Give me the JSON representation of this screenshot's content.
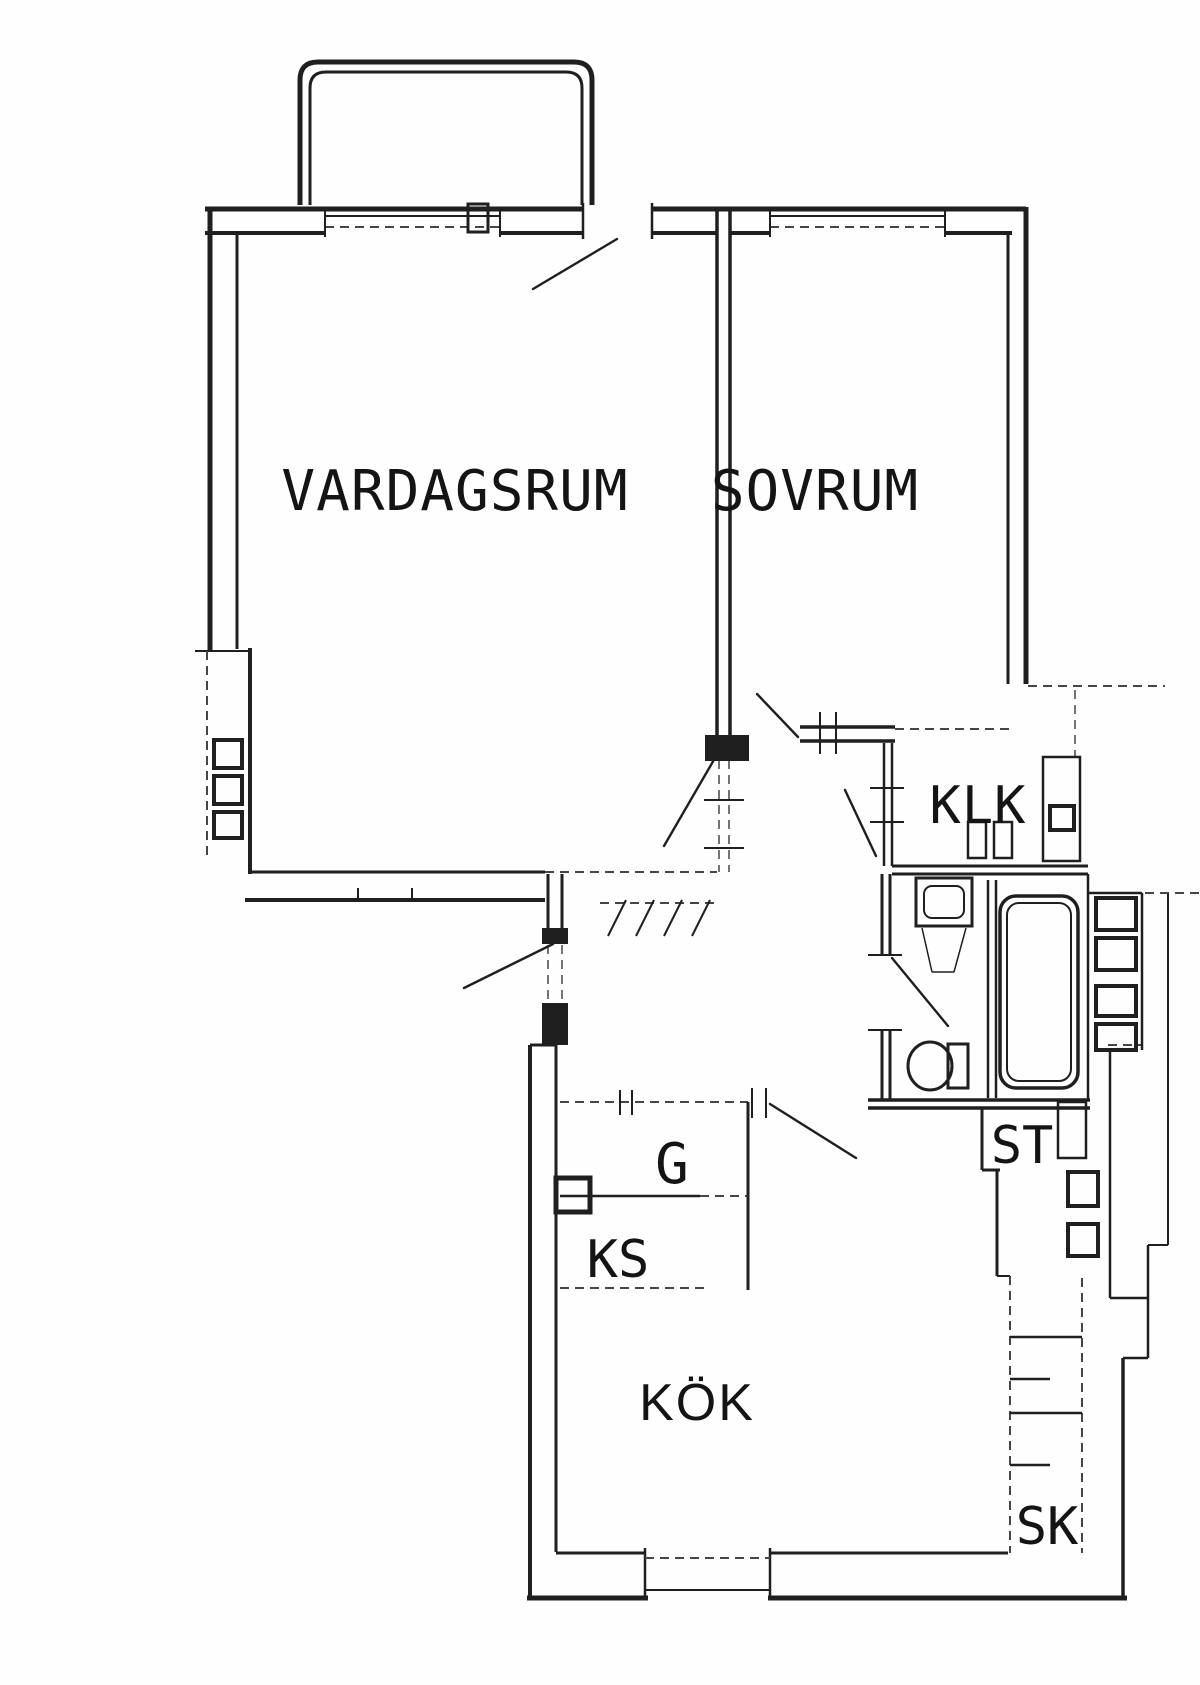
{
  "plan": {
    "background": "#fefefe",
    "ink": "#1f1f1f",
    "ink_soft": "#454545",
    "text_color": "#141414",
    "width": 1200,
    "height": 1685,
    "labels": [
      {
        "n": "room-label-vardagsrum",
        "t": "VARDAGSRUM",
        "x": 455,
        "y": 510,
        "s": 56,
        "f": "mono",
        "ls": 1
      },
      {
        "n": "room-label-sovrum",
        "t": "SOVRUM",
        "x": 815,
        "y": 510,
        "s": 56,
        "f": "mono",
        "ls": 1
      },
      {
        "n": "room-label-klk",
        "t": "KLK",
        "x": 978,
        "y": 823,
        "s": 52,
        "f": "mono",
        "ls": 1
      },
      {
        "n": "closet-label-g",
        "t": "G",
        "x": 672,
        "y": 1183,
        "s": 56,
        "f": "mono",
        "ls": 0
      },
      {
        "n": "appliance-label-ks",
        "t": "KS",
        "x": 618,
        "y": 1277,
        "s": 52,
        "f": "mono",
        "ls": 0
      },
      {
        "n": "closet-label-st",
        "t": "ST",
        "x": 1022,
        "y": 1163,
        "s": 52,
        "f": "mono",
        "ls": 0
      },
      {
        "n": "room-label-kok",
        "t": "KÖK",
        "x": 697,
        "y": 1420,
        "s": 52,
        "f": "sans",
        "ls": 2
      },
      {
        "n": "closet-label-sk",
        "t": "SK",
        "x": 1047,
        "y": 1544,
        "s": 52,
        "f": "mono",
        "ls": 0
      }
    ],
    "walls": [
      [
        205,
        209,
        583,
        209,
        5,
        0
      ],
      [
        652,
        209,
        1026,
        209,
        5,
        0
      ],
      [
        205,
        233,
        325,
        233,
        4,
        0
      ],
      [
        500,
        233,
        583,
        233,
        4,
        0
      ],
      [
        652,
        233,
        717,
        233,
        4,
        0
      ],
      [
        730,
        233,
        770,
        233,
        4,
        0
      ],
      [
        945,
        233,
        1012,
        233,
        4,
        0
      ],
      [
        325,
        216,
        500,
        216,
        2,
        0
      ],
      [
        325,
        227,
        500,
        227,
        2,
        1
      ],
      [
        325,
        207,
        325,
        237,
        2,
        0
      ],
      [
        500,
        207,
        500,
        237,
        2,
        0
      ],
      [
        770,
        216,
        945,
        216,
        2,
        0
      ],
      [
        770,
        227,
        945,
        227,
        2,
        1
      ],
      [
        770,
        207,
        770,
        237,
        2,
        0
      ],
      [
        945,
        207,
        945,
        237,
        2,
        0
      ],
      [
        583,
        203,
        583,
        239,
        2.5,
        0
      ],
      [
        652,
        203,
        652,
        239,
        2.5,
        0
      ],
      [
        210,
        207,
        210,
        651,
        5,
        0
      ],
      [
        237,
        233,
        237,
        649,
        3,
        0
      ],
      [
        195,
        651,
        250,
        651,
        2,
        0
      ],
      [
        207,
        651,
        207,
        858,
        2,
        1
      ],
      [
        250,
        648,
        250,
        874,
        4,
        0
      ],
      [
        1026,
        207,
        1026,
        684,
        5,
        0
      ],
      [
        1008,
        233,
        1008,
        684,
        3,
        0
      ],
      [
        1028,
        686,
        1165,
        686,
        2,
        1
      ],
      [
        1075,
        690,
        1075,
        757,
        1.5,
        1
      ],
      [
        717,
        209,
        717,
        741,
        3.5,
        0
      ],
      [
        730,
        209,
        730,
        741,
        3.5,
        0
      ],
      [
        719,
        760,
        719,
        872,
        1.5,
        1
      ],
      [
        729,
        760,
        729,
        872,
        1.5,
        1
      ],
      [
        704,
        800,
        744,
        800,
        2,
        0
      ],
      [
        704,
        848,
        744,
        848,
        2,
        0
      ],
      [
        800,
        727,
        895,
        727,
        3.5,
        0
      ],
      [
        800,
        741,
        895,
        741,
        3.5,
        0
      ],
      [
        895,
        729,
        1012,
        729,
        2,
        1
      ],
      [
        820,
        712,
        820,
        754,
        2,
        0
      ],
      [
        836,
        712,
        836,
        754,
        2,
        0
      ],
      [
        884,
        743,
        884,
        866,
        2.5,
        0
      ],
      [
        892,
        743,
        892,
        866,
        2.5,
        0
      ],
      [
        870,
        788,
        904,
        788,
        2,
        0
      ],
      [
        870,
        822,
        904,
        822,
        2,
        0
      ],
      [
        892,
        866,
        1088,
        866,
        3,
        0
      ],
      [
        892,
        874,
        1088,
        874,
        3,
        0
      ],
      [
        882,
        874,
        882,
        955,
        3,
        0
      ],
      [
        890,
        874,
        890,
        955,
        3,
        0
      ],
      [
        882,
        1030,
        882,
        1100,
        3,
        0
      ],
      [
        890,
        1030,
        890,
        1100,
        3,
        0
      ],
      [
        868,
        955,
        902,
        955,
        2,
        0
      ],
      [
        868,
        1030,
        902,
        1030,
        2,
        0
      ],
      [
        988,
        880,
        988,
        1098,
        2.5,
        0
      ],
      [
        996,
        880,
        996,
        1098,
        2.5,
        0
      ],
      [
        1088,
        874,
        1088,
        1100,
        2.5,
        0
      ],
      [
        868,
        1100,
        1090,
        1100,
        3.5,
        0
      ],
      [
        868,
        1108,
        1090,
        1108,
        3.5,
        0
      ],
      [
        250,
        872,
        545,
        872,
        3,
        0
      ],
      [
        545,
        872,
        717,
        872,
        2,
        1
      ],
      [
        245,
        900,
        545,
        900,
        4,
        0
      ],
      [
        358,
        888,
        358,
        902,
        2,
        0
      ],
      [
        412,
        888,
        412,
        902,
        2,
        0
      ],
      [
        548,
        874,
        548,
        940,
        3,
        0
      ],
      [
        562,
        874,
        562,
        940,
        3,
        0
      ],
      [
        548,
        945,
        548,
        1005,
        1.5,
        1
      ],
      [
        562,
        945,
        562,
        1005,
        1.5,
        1
      ],
      [
        600,
        903,
        718,
        903,
        2,
        1
      ],
      [
        608,
        936,
        626,
        900,
        2,
        0
      ],
      [
        636,
        936,
        654,
        900,
        2,
        0
      ],
      [
        664,
        936,
        682,
        900,
        2,
        0
      ],
      [
        692,
        936,
        710,
        900,
        2,
        0
      ],
      [
        530,
        1045,
        530,
        1598,
        4,
        0
      ],
      [
        556,
        1045,
        556,
        1552,
        3,
        0
      ],
      [
        530,
        1045,
        556,
        1045,
        3,
        0
      ],
      [
        560,
        1102,
        748,
        1102,
        2,
        1
      ],
      [
        620,
        1090,
        620,
        1115,
        2,
        0
      ],
      [
        632,
        1090,
        632,
        1115,
        2,
        0
      ],
      [
        560,
        1196,
        700,
        1196,
        2.5,
        0
      ],
      [
        700,
        1196,
        748,
        1196,
        2,
        1
      ],
      [
        748,
        1102,
        748,
        1290,
        3,
        0
      ],
      [
        560,
        1288,
        710,
        1288,
        2,
        1
      ],
      [
        752,
        1088,
        752,
        1118,
        2,
        0
      ],
      [
        766,
        1088,
        766,
        1118,
        2,
        0
      ],
      [
        556,
        1553,
        645,
        1553,
        3,
        0
      ],
      [
        770,
        1553,
        1008,
        1553,
        3,
        0
      ],
      [
        527,
        1598,
        648,
        1598,
        5,
        0
      ],
      [
        768,
        1598,
        1127,
        1598,
        5,
        0
      ],
      [
        645,
        1548,
        645,
        1600,
        2.5,
        0
      ],
      [
        770,
        1548,
        770,
        1600,
        2.5,
        0
      ],
      [
        645,
        1558,
        770,
        1558,
        2,
        1
      ],
      [
        645,
        1590,
        770,
        1590,
        2,
        0
      ],
      [
        982,
        1108,
        982,
        1170,
        3,
        0
      ],
      [
        982,
        1170,
        1000,
        1170,
        3,
        0
      ],
      [
        997,
        1170,
        997,
        1276,
        3,
        0
      ],
      [
        997,
        1276,
        1010,
        1276,
        2,
        0
      ],
      [
        1010,
        1276,
        1010,
        1553,
        2,
        1
      ],
      [
        1082,
        1278,
        1082,
        1553,
        2,
        1
      ],
      [
        1010,
        1337,
        1082,
        1337,
        2.5,
        0
      ],
      [
        1010,
        1379,
        1050,
        1379,
        2.5,
        0
      ],
      [
        1010,
        1413,
        1082,
        1413,
        2.5,
        0
      ],
      [
        1010,
        1465,
        1050,
        1465,
        2.5,
        0
      ],
      [
        1110,
        1048,
        1110,
        1298,
        2.5,
        0
      ],
      [
        1110,
        1298,
        1148,
        1298,
        2.5,
        0
      ],
      [
        1148,
        1245,
        1148,
        1358,
        2.5,
        0
      ],
      [
        1148,
        1245,
        1168,
        1245,
        2,
        0
      ],
      [
        1168,
        893,
        1168,
        1245,
        2,
        0
      ],
      [
        1145,
        893,
        1200,
        893,
        2,
        1
      ],
      [
        1123,
        1358,
        1148,
        1358,
        2.5,
        0
      ],
      [
        1123,
        1358,
        1123,
        1600,
        3.5,
        0
      ],
      [
        1108,
        1045,
        1142,
        1045,
        2,
        1
      ],
      [
        1142,
        893,
        1142,
        1050,
        2.5,
        0
      ],
      [
        1088,
        893,
        1142,
        893,
        2.5,
        0
      ],
      [
        922,
        928,
        932,
        972,
        1.5,
        0
      ],
      [
        966,
        928,
        954,
        972,
        1.5,
        0
      ],
      [
        932,
        972,
        954,
        972,
        1.5,
        0
      ]
    ],
    "door_leaves": [
      {
        "n": "balcony-door-leaf",
        "l": [
          617,
          239,
          533,
          289
        ]
      },
      {
        "n": "livingroom-door-leaf",
        "l": [
          715,
          758,
          664,
          846
        ]
      },
      {
        "n": "bedroom-door-leaf",
        "l": [
          798,
          737,
          757,
          694
        ]
      },
      {
        "n": "closet-door-leaf",
        "l": [
          845,
          790,
          876,
          856
        ]
      },
      {
        "n": "bathroom-door-leaf",
        "l": [
          892,
          958,
          948,
          1026
        ]
      },
      {
        "n": "entrance-door-leaf",
        "l": [
          553,
          944,
          464,
          988
        ]
      },
      {
        "n": "kitchen-door-leaf",
        "l": [
          770,
          1104,
          856,
          1158
        ]
      }
    ],
    "rects": [
      {
        "n": "window-mullion",
        "r": [
          468,
          204,
          20,
          28,
          3,
          0
        ]
      },
      {
        "n": "shaft-box",
        "r": [
          214,
          740,
          28,
          28,
          4,
          0
        ]
      },
      {
        "n": "shaft-box",
        "r": [
          214,
          776,
          28,
          28,
          4,
          0
        ]
      },
      {
        "n": "shaft-box",
        "r": [
          214,
          812,
          28,
          26,
          4,
          0
        ]
      },
      {
        "n": "klk-wardrobe-box",
        "r": [
          968,
          822,
          18,
          36,
          2.5,
          0
        ]
      },
      {
        "n": "klk-wardrobe-box",
        "r": [
          994,
          822,
          18,
          36,
          2.5,
          0
        ]
      },
      {
        "n": "duct-enclosure",
        "r": [
          1043,
          757,
          37,
          104,
          2.5,
          0
        ]
      },
      {
        "n": "duct-box",
        "r": [
          1050,
          806,
          24,
          24,
          4,
          0
        ]
      },
      {
        "n": "vent-shaft-box",
        "r": [
          556,
          1178,
          34,
          34,
          5,
          0
        ]
      },
      {
        "n": "st-door-panel",
        "r": [
          1058,
          1102,
          28,
          56,
          2.5,
          0
        ]
      },
      {
        "n": "shaft-box",
        "r": [
          1068,
          1172,
          30,
          34,
          4,
          0
        ]
      },
      {
        "n": "shaft-box",
        "r": [
          1068,
          1224,
          30,
          32,
          4,
          0
        ]
      },
      {
        "n": "shaft-box",
        "r": [
          1096,
          898,
          40,
          32,
          4,
          0
        ]
      },
      {
        "n": "shaft-box",
        "r": [
          1096,
          938,
          40,
          32,
          4,
          0
        ]
      },
      {
        "n": "shaft-box",
        "r": [
          1096,
          986,
          40,
          30,
          4,
          0
        ]
      },
      {
        "n": "shaft-box",
        "r": [
          1096,
          1024,
          40,
          26,
          4,
          0
        ]
      },
      {
        "n": "washbasin-outer",
        "r": [
          916,
          878,
          56,
          48,
          3,
          0
        ]
      },
      {
        "n": "washbasin-inner",
        "r": [
          924,
          886,
          40,
          32,
          2,
          8
        ]
      },
      {
        "n": "wc-cistern",
        "r": [
          948,
          1044,
          20,
          44,
          3,
          0
        ]
      },
      {
        "n": "bathtub-outer",
        "r": [
          1000,
          896,
          78,
          192,
          3.5,
          16
        ]
      },
      {
        "n": "bathtub-inner",
        "r": [
          1007,
          903,
          64,
          178,
          2,
          12
        ]
      }
    ],
    "filled_rects": [
      {
        "n": "wall-junction-block",
        "r": [
          705,
          735,
          44,
          26
        ]
      },
      {
        "n": "entrance-hinge-block",
        "r": [
          542,
          928,
          26,
          16
        ]
      },
      {
        "n": "entrance-pier-block",
        "r": [
          542,
          1003,
          26,
          42
        ]
      }
    ],
    "ellipses": [
      {
        "n": "wc-bowl",
        "e": [
          930,
          1066,
          22,
          24,
          3
        ]
      }
    ],
    "paths": [
      {
        "n": "balcony-railing-outer",
        "d": "M 300 205 L 300 80 Q 300 62 318 62 L 574 62 Q 592 62 592 80 L 592 205",
        "w": 5
      },
      {
        "n": "balcony-railing-inner",
        "d": "M 310 205 L 310 88 Q 310 72 326 72 L 566 72 Q 582 72 582 88 L 582 205",
        "w": 3
      }
    ]
  }
}
